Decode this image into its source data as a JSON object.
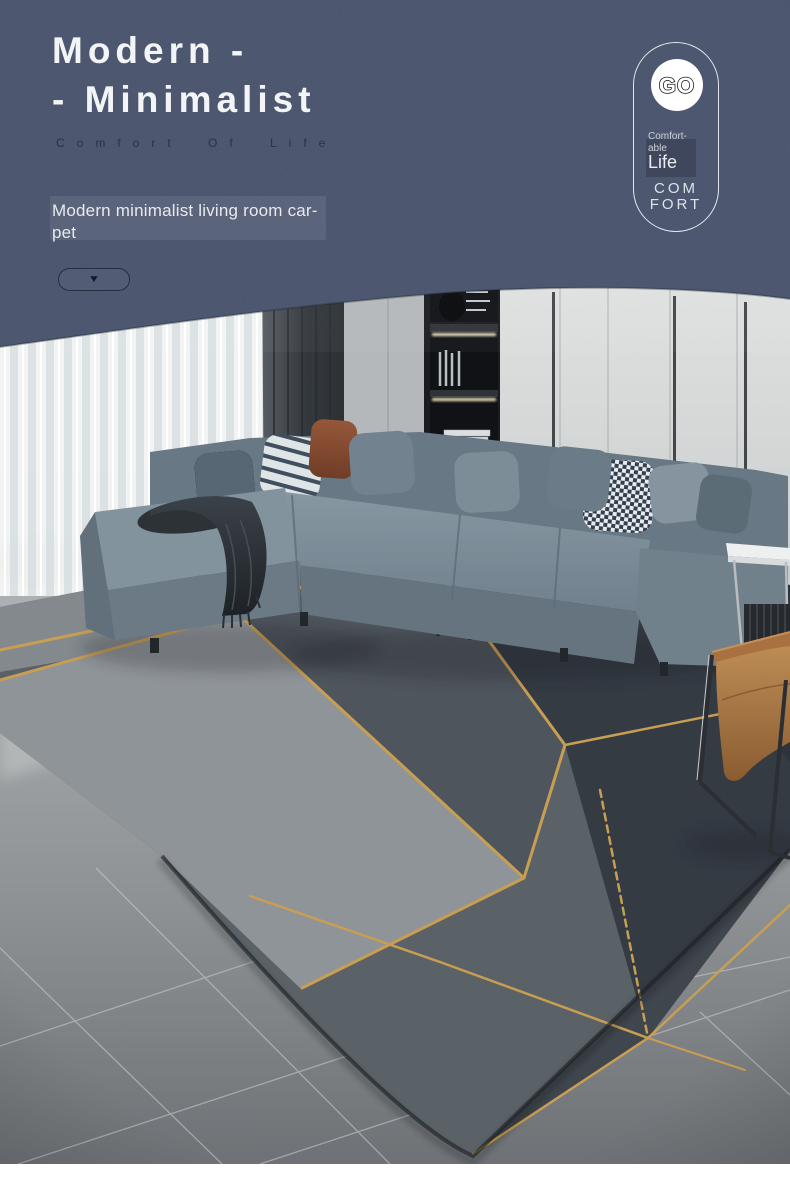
{
  "header": {
    "title_line1": "Modern -",
    "title_line2": "- Minimalist",
    "tagline": "Comfort Of Life",
    "description_line1": "Modern minimalist living room car-",
    "description_line2": "pet",
    "expand_arrow": "▼"
  },
  "badge": {
    "logo_text": "GO",
    "caption_line1": "Comfort-",
    "caption_line2": "able",
    "caption_line3": "Life",
    "footer_line1": "COM",
    "footer_line2": "FORT"
  },
  "colors": {
    "header_bg": "#47516a",
    "header_text": "#f2f4f6",
    "tagline_text": "#2a3345",
    "gold_accent": "#c79e52",
    "rug_dark": "#343b43",
    "rug_light": "#8f9498",
    "sofa_gray": "#7b8c98",
    "leather_tan": "#a9713f",
    "floor_gray": "#8d9194"
  },
  "scene": {
    "photo_alt": "Living room with gray L-shaped sectional sofa, assorted pillows, dark throw blanket, sheer white curtains, dark drape, lit shelving unit, white wardrobe, black table lamp, tan leather lounge chair and a large gray geometric area rug with gold lines on stone tile floor."
  }
}
